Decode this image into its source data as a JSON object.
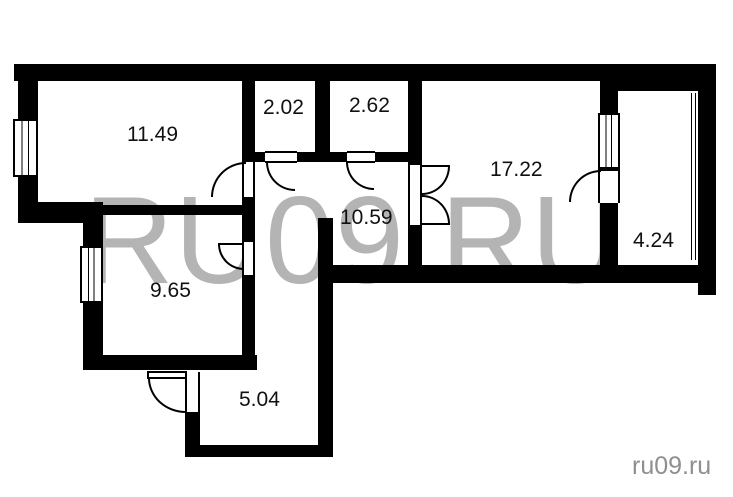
{
  "page": {
    "background": "#ffffff"
  },
  "watermark": {
    "large_text": "RU09.RU",
    "corner_text": "ru09.ru",
    "large_color": "#b4b4b4",
    "corner_color": "#8f8f8f"
  },
  "floorplan": {
    "type": "apartment-floor-plan",
    "wall_color": "#000000",
    "label_color": "#111111",
    "rooms": [
      {
        "area_label": "11.49"
      },
      {
        "area_label": "2.02"
      },
      {
        "area_label": "2.62"
      },
      {
        "area_label": "17.22"
      },
      {
        "area_label": "10.59"
      },
      {
        "area_label": "9.65"
      },
      {
        "area_label": "4.24"
      },
      {
        "area_label": "5.04"
      }
    ]
  }
}
